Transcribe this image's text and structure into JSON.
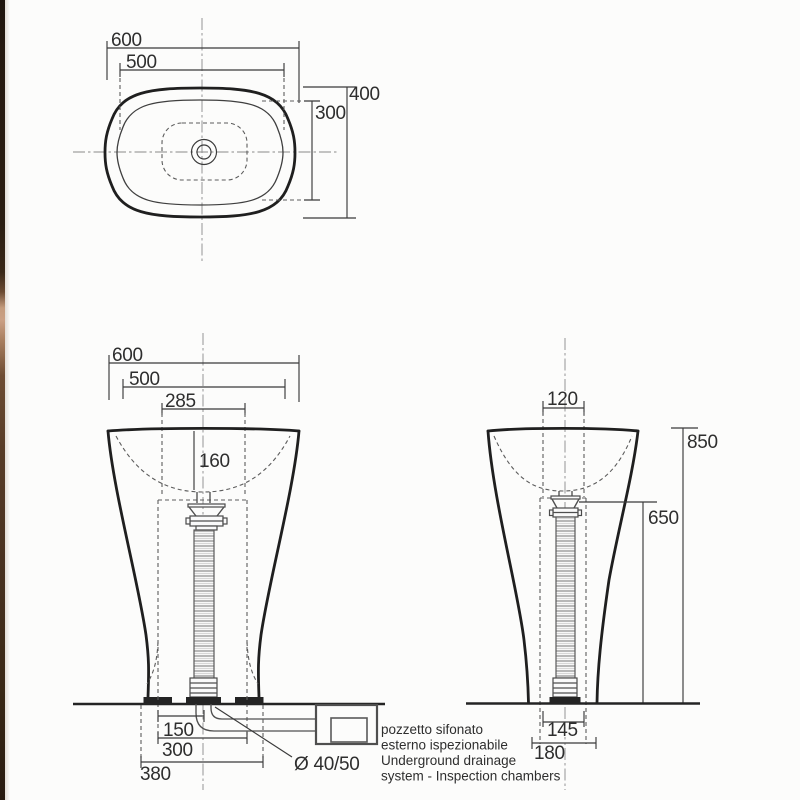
{
  "top_view": {
    "dim_overall_width": "600",
    "dim_inner_width": "500",
    "dim_overall_depth": "400",
    "dim_inner_depth": "300"
  },
  "front_view": {
    "dim_overall_width": "600",
    "dim_inner_width": "500",
    "dim_drain_width": "285",
    "dim_basin_depth": "160",
    "dim_drain_offset": "150",
    "dim_cavity_width": "300",
    "dim_base_width": "380",
    "dim_drain_diameter": "Ø 40/50"
  },
  "side_view": {
    "dim_top_cavity_width": "120",
    "dim_total_height": "850",
    "dim_drain_height": "650",
    "dim_bottom_cavity_width": "145",
    "dim_base_depth": "180"
  },
  "note": {
    "lines": [
      "pozzetto sifonato",
      "esterno ispezionabile",
      "Underground drainage",
      "system - Inspection chambers"
    ]
  },
  "colors": {
    "line": "#2e2e2e",
    "outline": "#1f1f1f",
    "background": "#fcfcfb",
    "strip_dark": "#26190f",
    "strip_light": "#cba084"
  }
}
